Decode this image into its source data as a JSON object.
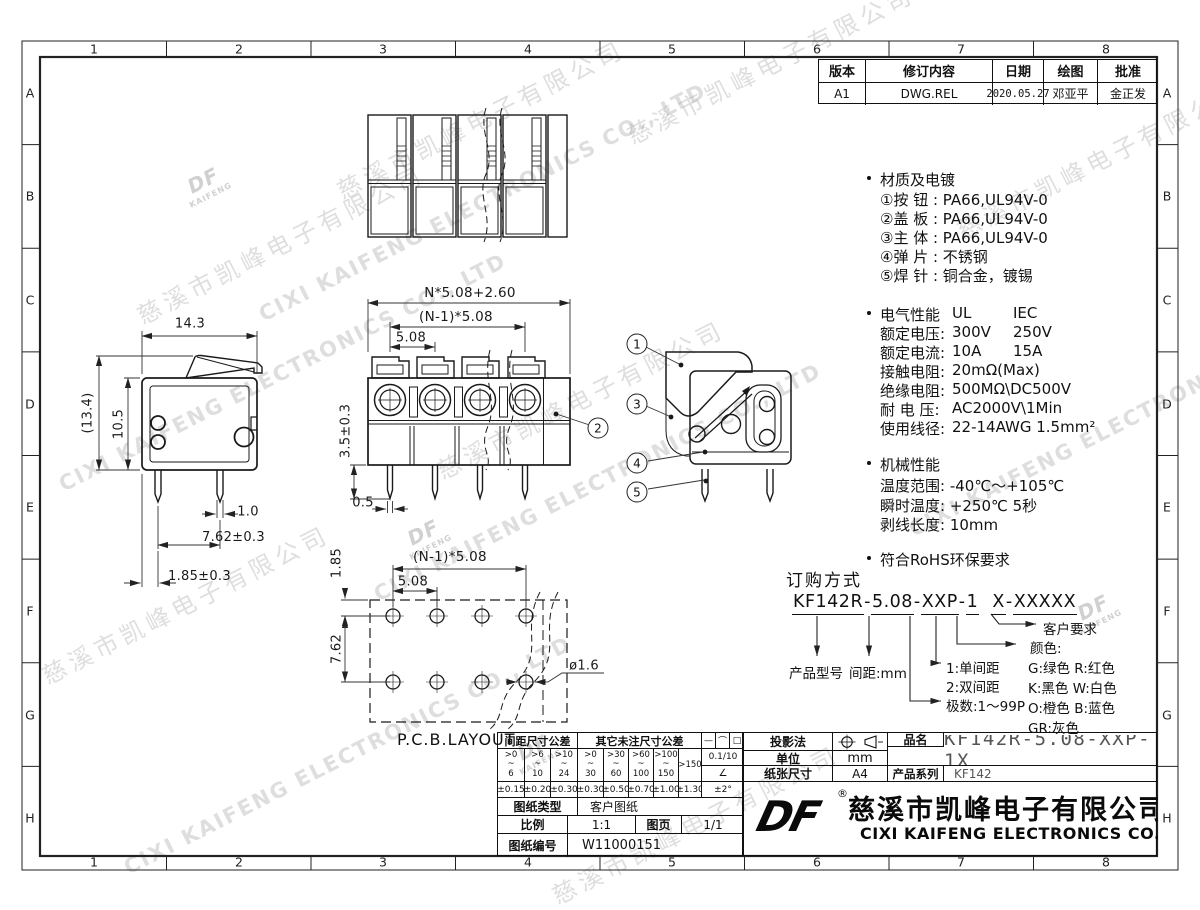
{
  "frame": {
    "columns": [
      "1",
      "2",
      "3",
      "4",
      "5",
      "6",
      "7",
      "8"
    ],
    "rows": [
      "A",
      "B",
      "C",
      "D",
      "E",
      "F",
      "G",
      "H"
    ]
  },
  "watermark": {
    "cn": "慈溪市凯峰电子有限公司",
    "en": "CIXI KAIFENG ELECTRONICS CO., LTD",
    "logo_top": "DF",
    "logo_bottom": "KAIFENG"
  },
  "revision": {
    "headers": [
      "版本",
      "修订内容",
      "日期",
      "绘图",
      "批准"
    ],
    "row": [
      "A1",
      "DWG.REL",
      "2020.05.27",
      "邓亚平",
      "金正发"
    ]
  },
  "specs": {
    "material": {
      "title": "材质及电镀",
      "items": [
        "①按 钮 : PA66,UL94V-0",
        "②盖 板 : PA66,UL94V-0",
        "③主 体 : PA66,UL94V-0",
        "④弹 片 : 不锈钢",
        "⑤焊 针 : 铜合金，镀锡"
      ]
    },
    "electrical": {
      "title": "电气性能",
      "col1": "UL",
      "col2": "IEC",
      "rows": [
        {
          "label": "额定电压:",
          "v1": "300V",
          "v2": "250V"
        },
        {
          "label": "额定电流:",
          "v1": "10A",
          "v2": "15A"
        },
        {
          "label": "接触电阻:",
          "v1": "20mΩ(Max)",
          "v2": ""
        },
        {
          "label": "绝缘电阻:",
          "v1": "500MΩ\\DC500V",
          "v2": ""
        },
        {
          "label": "耐 电 压:",
          "v1": "AC2000V\\1Min",
          "v2": ""
        },
        {
          "label": "使用线径:",
          "v1": "22-14AWG 1.5mm²",
          "v2": ""
        }
      ]
    },
    "mechanical": {
      "title": "机械性能",
      "rows": [
        "温度范围: -40℃～+105℃",
        "瞬时温度: +250℃ 5秒",
        "剥线长度: 10mm"
      ]
    },
    "rohs": "符合RoHS环保要求"
  },
  "ordering": {
    "title": "订购方式",
    "parts": [
      "KF142R",
      "-",
      "5.08",
      "-",
      "XXP",
      "-",
      "1",
      "  ",
      "X",
      "-",
      "XXXXX"
    ],
    "product_model": "产品型号",
    "pitch_label": "间距:mm",
    "pitch_opt1": "1:单间距",
    "pitch_opt2": "2:双间距",
    "poles": "极数:1～99P",
    "color_title": "颜色:",
    "color_rows": [
      "G:绿色  R:红色",
      "K:黑色  W:白色",
      "O:橙色  B:蓝色",
      "GR:灰色"
    ],
    "customer": "客户要求"
  },
  "tolerance_table": {
    "pitch_header": "间距尺寸公差",
    "other_header": "其它未注尺寸公差",
    "symbols": [
      "—",
      "⌒",
      "□"
    ],
    "ranges": [
      ">0\n~\n6",
      ">6\n~\n10",
      ">10\n~\n24",
      ">0\n~\n30",
      ">30\n~\n60",
      ">60\n~\n100",
      ">100\n~\n150"
    ],
    "range_last": ">150",
    "flatness": "0.1/10",
    "angle_symbol": "∠",
    "values": [
      "±0.15",
      "±0.20",
      "±0.30",
      "±0.30",
      "±0.50",
      "±0.70",
      "±1.00",
      "±1.30"
    ],
    "angle_value": "±2°",
    "type_label": "图纸类型",
    "type_value": "客户图纸",
    "scale_label": "比例",
    "scale_value": "1:1",
    "sheet_label": "图页",
    "sheet_value": "1/1",
    "number_label": "图纸编号",
    "number_value": "W11000151"
  },
  "title_block": {
    "projection_label": "投影法",
    "unit_label": "单位",
    "unit_value": "mm",
    "paper_label": "纸张尺寸",
    "paper_value": "A4",
    "name_label": "品名",
    "name_value": "KF142R-5.08-XXP-1X",
    "series_label": "产品系列",
    "series_value": "KF142",
    "logo": "DF",
    "registered": "®",
    "company_cn": "慈溪市凯峰电子有限公司",
    "company_en": "CIXI KAIFENG ELECTRONICS CO.,LTD"
  },
  "dimensions": {
    "side_view": {
      "width": "14.3",
      "height_total": "(13.4)",
      "height_body": "10.5",
      "pin_width": "1.0",
      "pin_pitch": "7.62±0.3",
      "pin_offset": "1.85±0.3"
    },
    "front_view": {
      "total": "N*5.08+2.60",
      "span": "(N-1)*5.08",
      "pitch": "5.08",
      "pin_length": "3.5±0.3",
      "pin_thickness": "0.5"
    },
    "pcb": {
      "offset": "1.85",
      "span": "(N-1)*5.08",
      "pitch": "5.08",
      "row_pitch": "7.62",
      "hole_dia": "ø1.6",
      "label": "P.C.B.LAYOUT"
    }
  },
  "balloons": {
    "b1": "1",
    "b2": "2",
    "b3": "3",
    "b4": "4",
    "b5": "5"
  }
}
